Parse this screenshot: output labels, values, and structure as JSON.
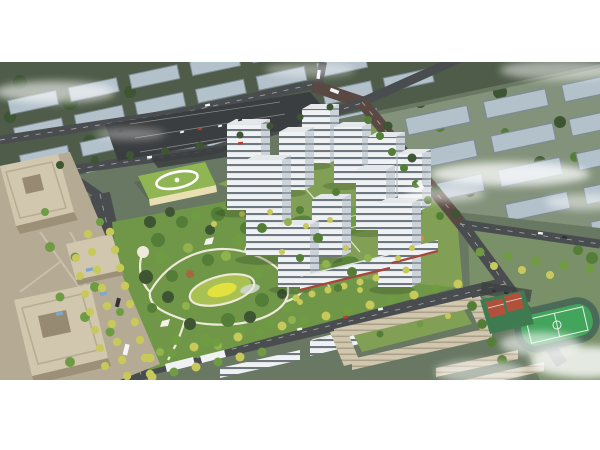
{
  "figure": {
    "kind": "aerial architectural rendering",
    "scene": "bird's-eye master-plan view of a residential development: central landscaped park with yellow lawn and winding white paths, white high-rise apartment towers, kindergarten with green roof and white oval ring, beige office towers with plaza, tree-lined avenues, commercial street, school campus and a sports field with running track, surrounded by rows of grey context buildings and drifting clouds"
  },
  "palette": {
    "white": "#ffffff",
    "terrain_base": "#687862",
    "terrain_dark": "#4e5c49",
    "terrain_light": "#83927b",
    "terrain_apron": "#7a9069",
    "context_roof": "#b3c1cb",
    "context_side": "#7e8a96",
    "road": "#4a4d4f",
    "road_dark": "#3b3e40",
    "road_brown": "#5a4843",
    "road_mark": "#d9d8d0",
    "plaza": "#b5aa93",
    "office_roof": "#d1c7af",
    "office_side": "#9c9178",
    "office_court": "#968b72",
    "tower_face": "#f0f1f3",
    "tower_side": "#ccd3d9",
    "tower_roof": "#e5e8ea",
    "tower_window": "#5e6973",
    "shopfront_red": "#a8453a",
    "kindergarten_roof": "#90b654",
    "kindergarten_wall": "#eadfb2",
    "park_base": "#6f9747",
    "compound_ground": "#81a055",
    "lawn_yellow": "#e2e23e",
    "lawn_light": "#a9c153",
    "path": "#efe9da",
    "pond": "#ccd6cf",
    "tree_dark": "#3d5533",
    "tree_mid": "#547e37",
    "tree_green": "#6f9c42",
    "tree_light": "#90b24f",
    "tree_yellow": "#c8c95b",
    "tree_red": "#a5683c",
    "field_green": "#43a45c",
    "field_pad": "#3e7b50",
    "track_ring": "#4a6b57",
    "court_red": "#b0523b",
    "playground_orange": "#d8923c",
    "awning_blue": "#7fa7c9",
    "car_white": "#f3f4f4",
    "car_red": "#c23a2e",
    "car_dark": "#2e3336",
    "cloud": "#ffffff"
  }
}
